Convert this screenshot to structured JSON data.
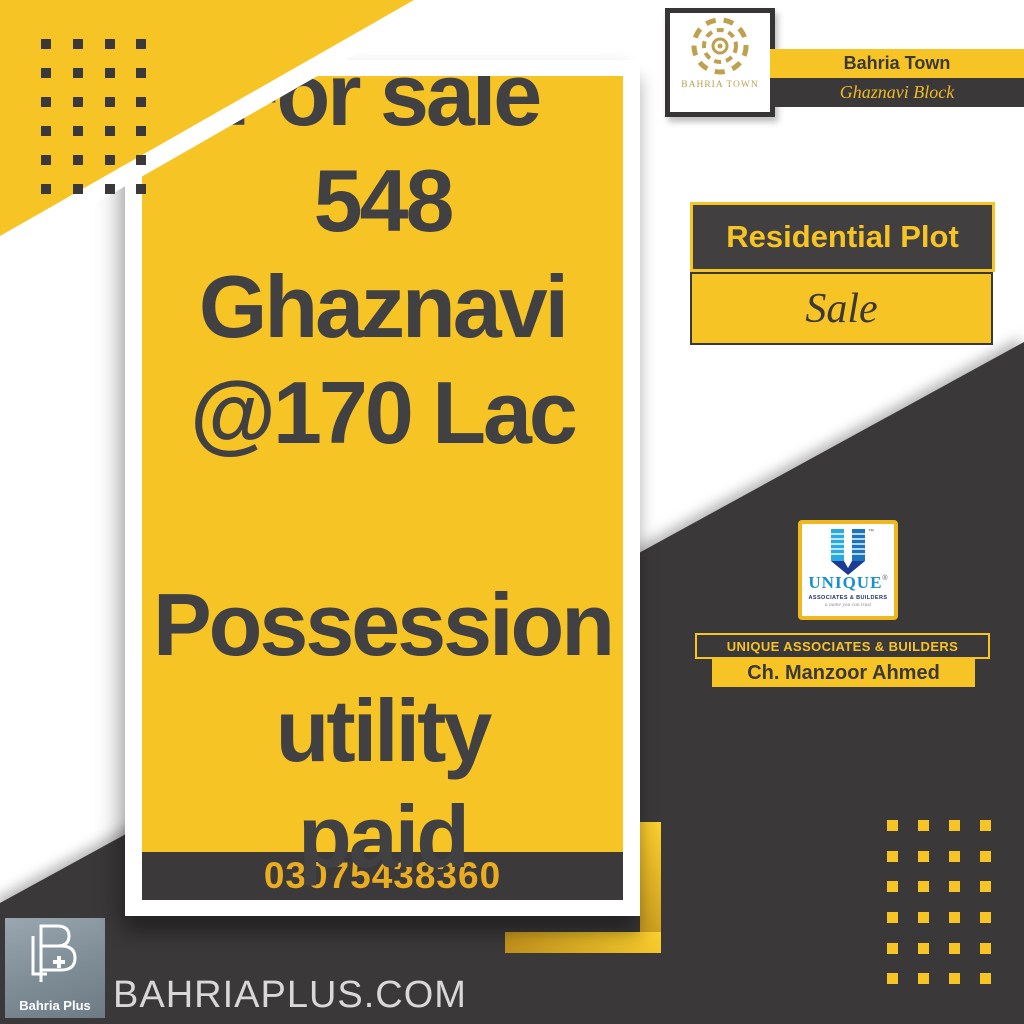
{
  "poster": {
    "main_card": {
      "lines": [
        "For sale",
        "548",
        "Ghaznavi",
        "@170 Lac",
        "",
        "Possession",
        "utility",
        "paid"
      ],
      "phone": "03075438360"
    },
    "bahria_town_badge": {
      "logo_text": "BAHRIA TOWN",
      "title": "Bahria Town",
      "subtitle": "Ghaznavi Block"
    },
    "listing": {
      "type_label": "Residential Plot",
      "status_label": "Sale"
    },
    "agency": {
      "logo_word": "UNIQUE",
      "logo_tm": "™",
      "logo_r": "®",
      "logo_sub": "ASSOCIATES & BUILDERS",
      "logo_tagline": "a name you can trust",
      "bar_company": "UNIQUE ASSOCIATES & BUILDERS",
      "bar_agent": "Ch. Manzoor Ahmed"
    },
    "footer_brand": {
      "name": "Bahria Plus",
      "monogram": "B+",
      "website": "BAHRIAPLUS.COM"
    },
    "colors": {
      "yellow": "#F7C425",
      "dark": "#3B3839",
      "text_dark": "#414042",
      "phone_yellow": "#EBAD20",
      "gold": "#BFA04F",
      "blue_light": "#29ABE2",
      "blue_dark": "#1B75BC",
      "blue_navy": "#1C3C94",
      "website_gray": "#D8D8D8"
    },
    "decor": {
      "dots_top_left": {
        "cols": 4,
        "rows": 6
      },
      "dots_bottom_right": {
        "cols": 4,
        "rows": 6
      }
    }
  }
}
